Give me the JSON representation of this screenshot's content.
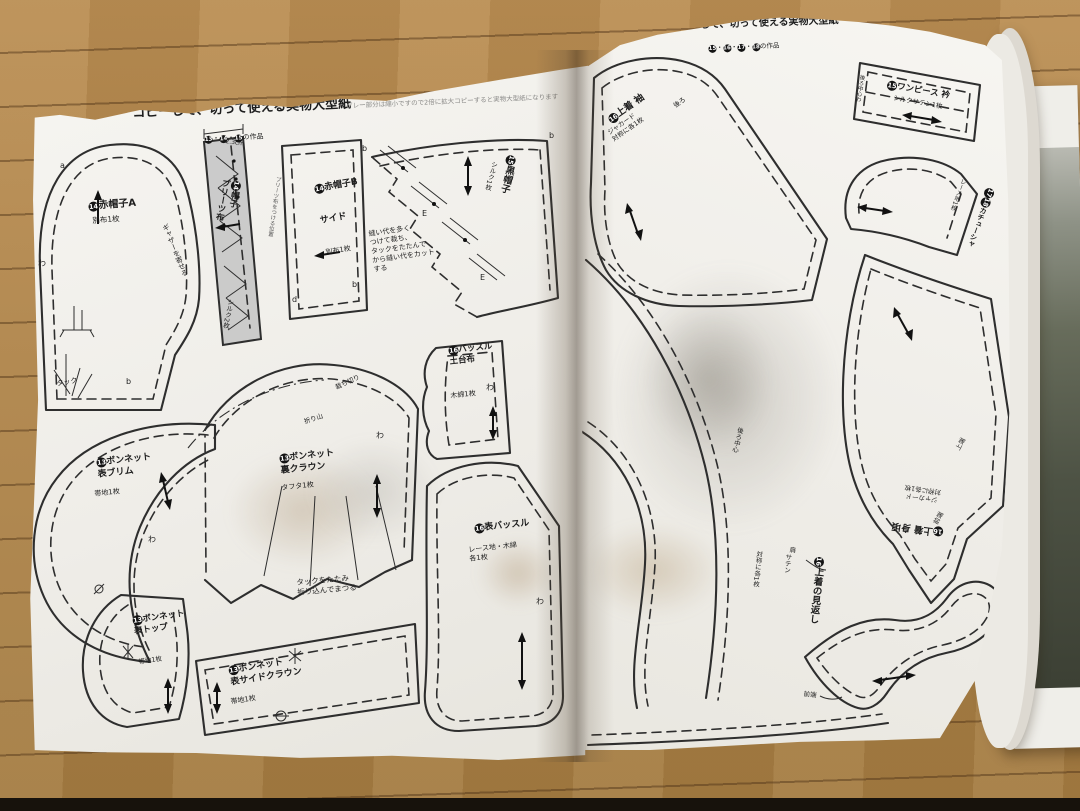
{
  "colors": {
    "paper": "#f3f2ee",
    "wood": "#b0854a",
    "ink": "#2e2e2e",
    "pleat_gray": "#c7c7c7"
  },
  "left_page": {
    "title": "コピーして、切って使える実物大型紙",
    "works_nums": [
      "13",
      "14",
      "15"
    ],
    "works_suffix": "の作品",
    "copy_note": "グレー部分は縮小ですので2倍に拡大コピーすると実物大型紙になります",
    "pieces": {
      "hat_a": {
        "num": "14",
        "name": "赤帽子A",
        "material": "別布1枚"
      },
      "pleats": {
        "num": "14",
        "name": "帽子\nプリーツ布",
        "material": "シルク2枚",
        "width": "2.3cm"
      },
      "hat_b": {
        "num": "14",
        "name": "赤帽子B",
        "sub": "サイド",
        "material": "別布1枚",
        "side_note": "プリーツ布をつける位置"
      },
      "black_hat": {
        "num": "15",
        "name": "黒帽子",
        "material": "シルク1枚",
        "note": "縫い代を多く\nつけて裁ち、\nタックをたたんで\nから縫い代をカット\nする"
      },
      "bustle_base": {
        "num": "16",
        "name": "バッスル\n土台布",
        "material": "木綿1枚"
      },
      "brim": {
        "num": "13",
        "name": "ボンネット\n表ブリム",
        "material": "帯地1枚"
      },
      "crown_back": {
        "num": "13",
        "name": "ボンネット\n裏クラウン",
        "material": "タフタ1枚",
        "tuck_note": "タックをたたみ\n折り込んでまつる"
      },
      "bustle_front": {
        "num": "16",
        "name": "表バッスル",
        "material": "レース地・木綿\n各1枚"
      },
      "top": {
        "num": "13",
        "name": "ボンネット\n表トップ",
        "material": "帯地1枚"
      },
      "side_crown": {
        "num": "13",
        "name": "ボンネット\n表サイドクラウン",
        "material": "帯地1枚"
      }
    },
    "annotations": {
      "gather": "ギャザーを寄せる",
      "tuck": "タック",
      "fold_line": "折り山",
      "cut_edge": "裁ち切り"
    },
    "marks": {
      "a": "a",
      "b": "b",
      "d": "d",
      "e": "E",
      "wa": "わ"
    }
  },
  "right_page": {
    "title": "コピーして、切って使える実物大型紙",
    "works_nums": [
      "15",
      "16",
      "17",
      "18"
    ],
    "works_suffix": "の作品",
    "pieces": {
      "sleeve": {
        "num": "16",
        "name": "上着 袖",
        "material": "ジャカード\n対称に各1枚"
      },
      "collar": {
        "num": "15",
        "name": "ワンピース 衿",
        "material": "シルクサテン1枚",
        "end_note": "後ろ中心わ"
      },
      "headband": {
        "nums": [
          "17",
          "18"
        ],
        "name": "カチューシャ",
        "material": "レース地1枚"
      },
      "bodice": {
        "num": "16",
        "name": "上着 身頃",
        "material": "ジャカード\n対称に各1枚"
      },
      "facing": {
        "num": "16",
        "name": "上着の見返し",
        "material_1": "サテン",
        "material_2": "対称に各1枚"
      }
    },
    "annotations": {
      "back": "後ろ",
      "center_back": "後ろ中心",
      "top_edge": "上端",
      "front_edge": "前端",
      "shoulder": "肩"
    },
    "marks": {
      "wa": "わ"
    }
  }
}
